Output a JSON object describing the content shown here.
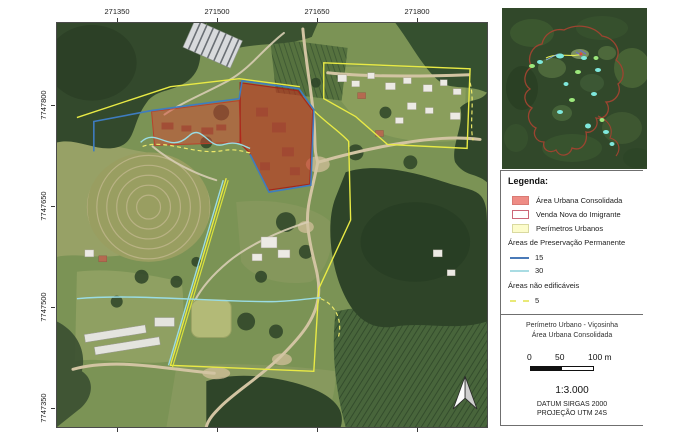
{
  "axis": {
    "x": [
      "271350",
      "271500",
      "271650",
      "271800"
    ],
    "y": [
      "7747800",
      "7747650",
      "7747500",
      "7747350"
    ]
  },
  "legend": {
    "title": "Legenda:",
    "items": [
      {
        "label": "Área Urbana Consolidada",
        "fill": "#ee8c85",
        "border": "#d97a74"
      },
      {
        "label": "Venda Nova do Imigrante",
        "fill": "#ffffff",
        "border": "#cc6677"
      },
      {
        "label": "Perímetros Urbanos",
        "fill": "#fcfccb",
        "border": "#d9d9a0"
      }
    ],
    "groups": [
      {
        "heading": "Áreas de Preservação Permanente",
        "items": [
          {
            "label": "15",
            "color": "#4a7ab8",
            "style": "solid"
          },
          {
            "label": "30",
            "color": "#a9dce3",
            "style": "solid"
          }
        ]
      },
      {
        "heading": "Áreas não edificáveis",
        "items": [
          {
            "label": "5",
            "color": "#e9e978",
            "style": "dashed"
          }
        ]
      }
    ]
  },
  "title_block": {
    "line1": "Perímetro Urbano - Viçosinha",
    "line2": "Área Urbana Consolidada"
  },
  "scale_bar": {
    "label_0": "0",
    "label_50": "50",
    "label_100": "100 m",
    "ratio": "1:3.000",
    "datum": "DATUM SIRGAS 2000",
    "projection": "PROJEÇÃO UTM 24S"
  },
  "map_colors": {
    "urban_area_fill": "#c62c1e",
    "app_15_line": "#3e7cc0",
    "app_30_line": "#9adce4",
    "perimeter_line": "#e9ea45",
    "inset_boundary": "#9c4430"
  }
}
